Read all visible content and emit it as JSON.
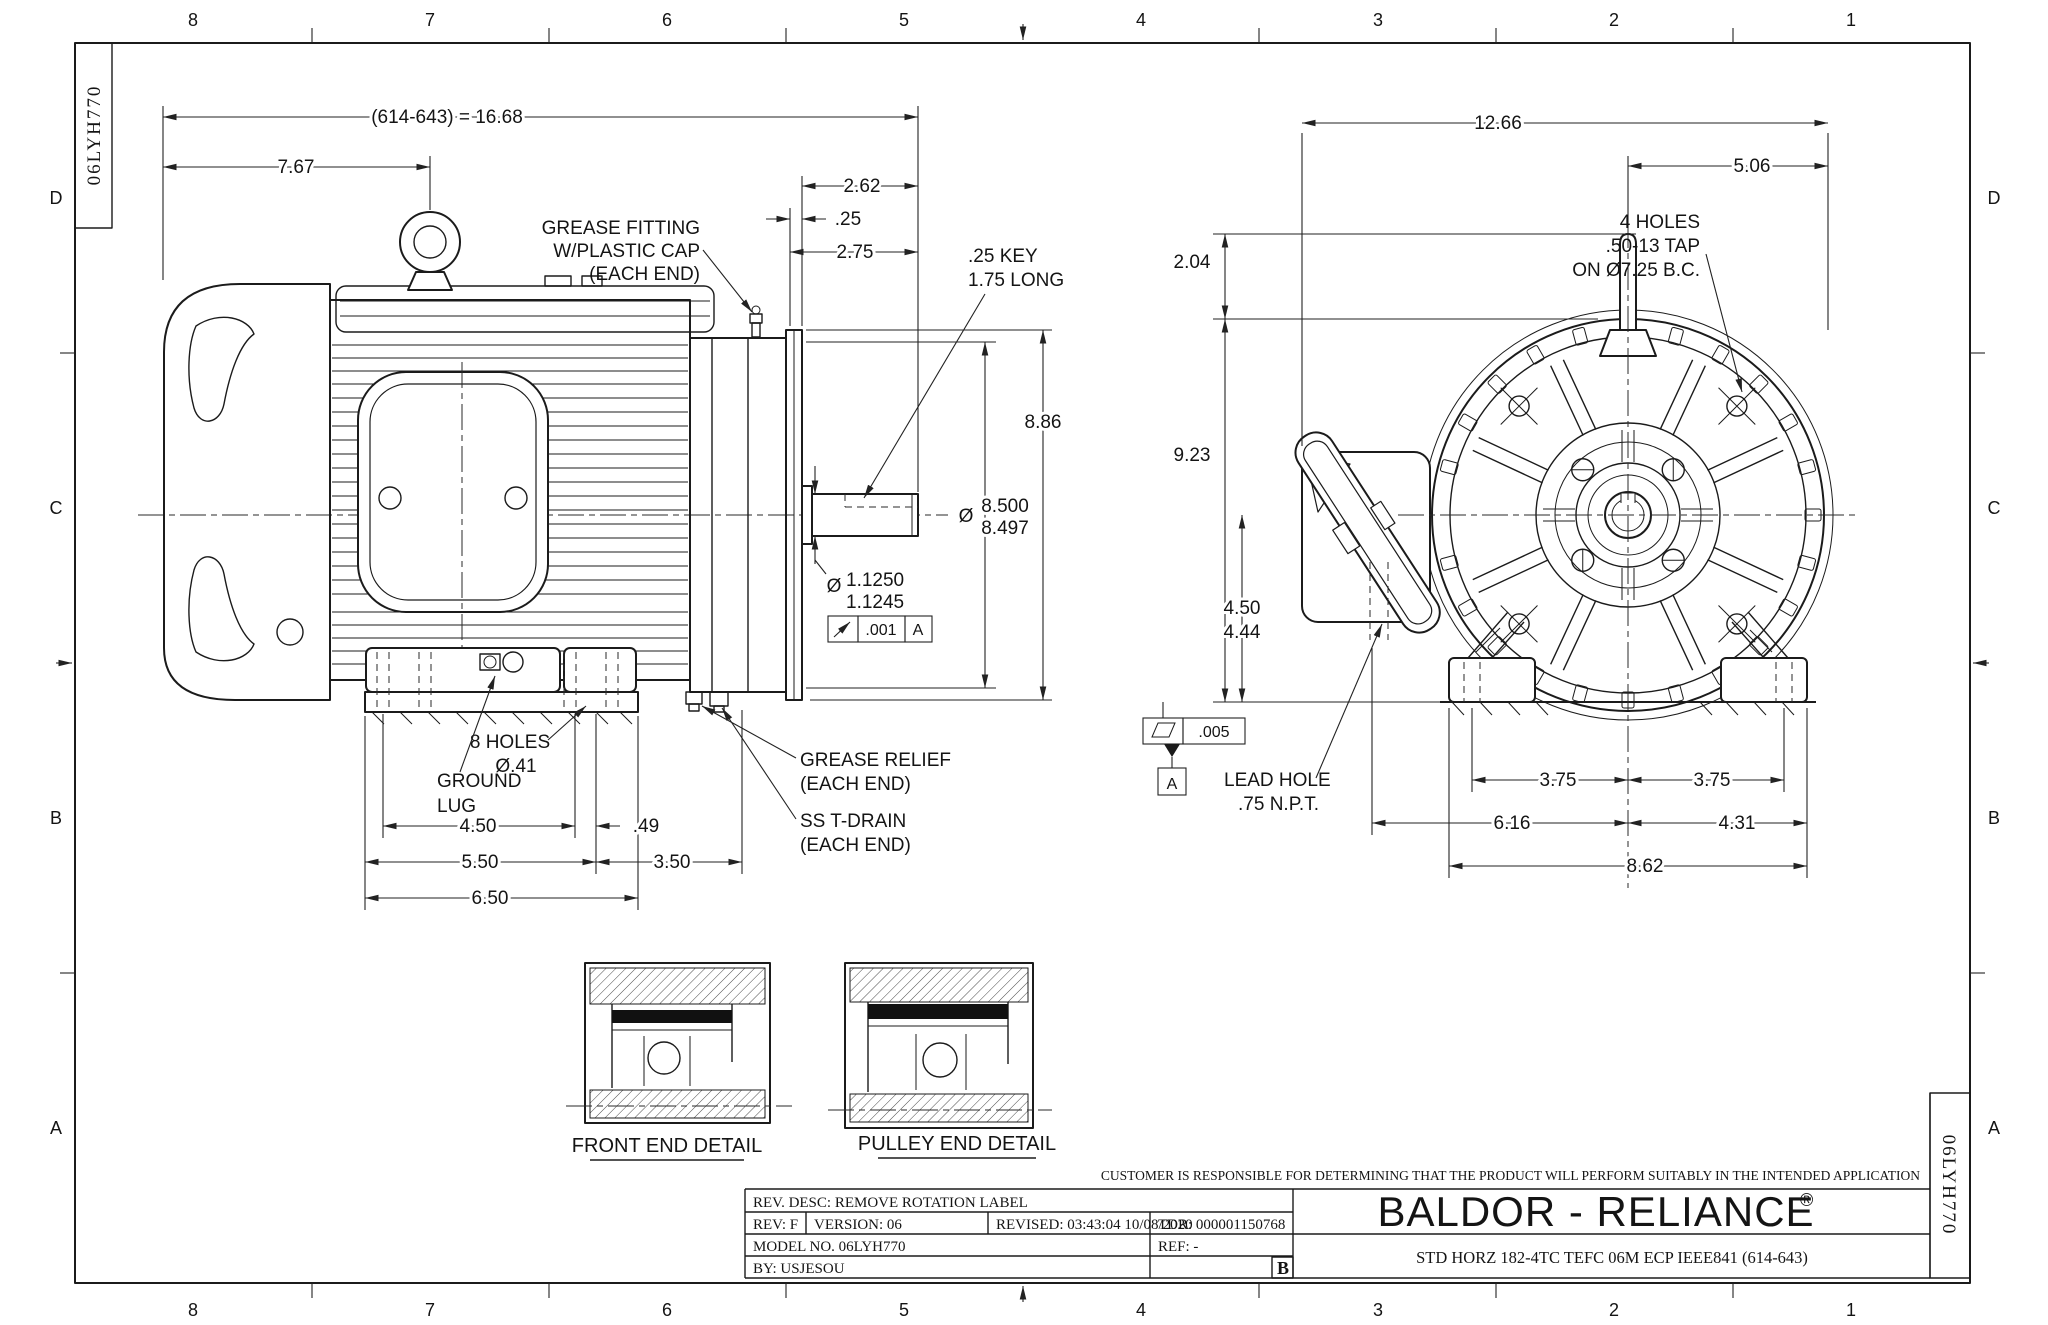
{
  "sheet": {
    "id": "06LYH770",
    "cols": [
      "8",
      "7",
      "6",
      "5",
      "4",
      "3",
      "2",
      "1"
    ],
    "rows": [
      "D",
      "C",
      "B",
      "A"
    ]
  },
  "side_view": {
    "dims": {
      "overall": "(614-643) = 16.68",
      "to_eyebolt": "7.67",
      "shaft_ext": "2.62",
      "flange": ".25",
      "face": "2.75",
      "flange_od": "8.86",
      "feet_span": "4.50",
      "foot_off": ".49",
      "feet_mid": "5.50",
      "foot_rear": "3.50",
      "feet_out": "6.50"
    },
    "shaft_fit": {
      "phi": "Ø",
      "upper": "8.500",
      "lower": "8.497"
    },
    "key_fit": {
      "phi": "Ø",
      "upper": "1.1250",
      "lower": "1.1245"
    },
    "runout": {
      "tol": ".001",
      "datum": "A"
    },
    "labels": {
      "grease_fitting": [
        "GREASE FITTING",
        "W/PLASTIC CAP",
        "(EACH END)"
      ],
      "key": [
        ".25 KEY",
        "1.75 LONG"
      ],
      "holes": [
        "8 HOLES",
        "Ø.41"
      ],
      "ground": [
        "GROUND",
        "LUG"
      ],
      "relief": [
        "GREASE RELIEF",
        "(EACH END)"
      ],
      "drain": [
        "SS T-DRAIN",
        "(EACH END)"
      ]
    }
  },
  "end_view": {
    "dims": {
      "width": "12.66",
      "shaft_to_face": "5.06",
      "eyebolt": "2.04",
      "height": "9.23",
      "d_nom": "4.50",
      "d_min": "4.44",
      "bc_left": "3.75",
      "bc_right": "3.75",
      "lead_off": "6.16",
      "foot_off": "4.31",
      "base": "8.62"
    },
    "flatness": {
      "tol": ".005",
      "datum": "A"
    },
    "labels": {
      "tap": [
        "4 HOLES",
        ".50-13 TAP",
        "ON Ø7.25 B.C."
      ],
      "lead": [
        "LEAD HOLE",
        ".75 N.P.T."
      ]
    }
  },
  "details": {
    "front": "FRONT END DETAIL",
    "pulley": "PULLEY END DETAIL"
  },
  "rev_table": {
    "rev_desc": "REV. DESC: REMOVE ROTATION LABEL",
    "rev": "REV:  F",
    "version": "VERSION:  06",
    "revised": "REVISED: 03:43:04 10/08/2020",
    "tdr": "TDR: 000001150768",
    "model": "MODEL NO.   06LYH770",
    "ref": "REF:  -",
    "by": "BY: USJESOU",
    "size": "B"
  },
  "title_block": {
    "disclaimer": "CUSTOMER IS RESPONSIBLE FOR DETERMINING THAT THE PRODUCT WILL PERFORM SUITABLY IN THE INTENDED APPLICATION",
    "brand": "BALDOR - RELIANCE",
    "registered": "®",
    "description": "STD HORZ 182-4TC TEFC 06M ECP IEEE841 (614-643)"
  }
}
